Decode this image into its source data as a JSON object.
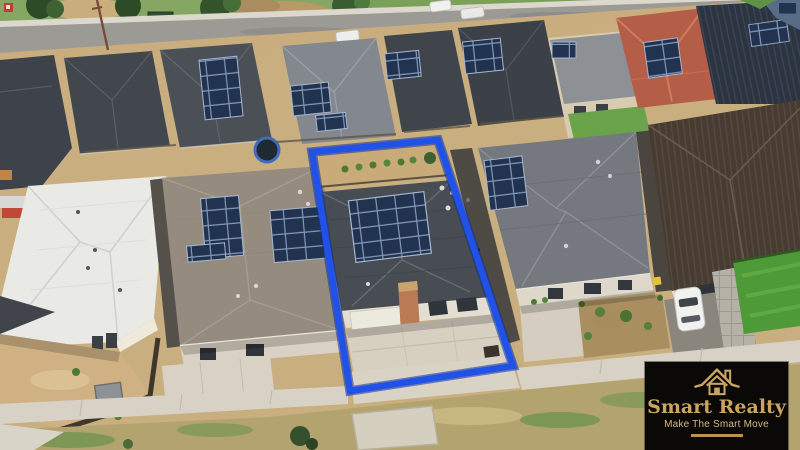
{
  "overlay": {
    "boundary_color": "#2052e8",
    "boundary_glow_color": "#10309b"
  },
  "logo": {
    "title": "Smart Realty",
    "tagline": "Make The Smart Move",
    "icon": "house-roof-icon",
    "background_color": "#0b0907",
    "gold_color": "#c9a55f"
  }
}
